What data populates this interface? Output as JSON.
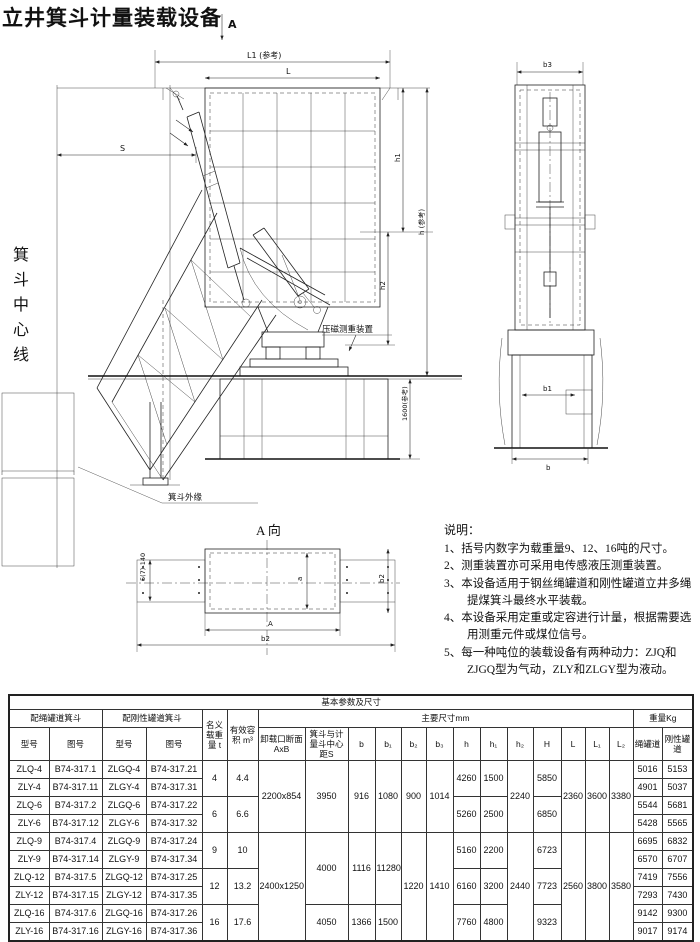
{
  "page": {
    "title": "立井箕斗计量装载设备"
  },
  "drawing": {
    "section_marker": "A",
    "dims": {
      "L1": "L1 (参考)",
      "L": "L",
      "S": "S",
      "h1": "h1",
      "h2": "h2",
      "h_ref": "h (参考)",
      "ref_1600": "1600(参考)",
      "b3": "b3",
      "b1": "b1",
      "b": "b",
      "a_view_left": "5(7)-140",
      "a_view_inner_v": "a",
      "a_view_inner_h": "A",
      "a_view_outer_h": "b2",
      "a_view_right_v": "b2"
    },
    "labels": {
      "skip_centerline": "箕斗中心线",
      "weighing_device": "压磁测重装置",
      "skip_outer_edge": "箕斗外缘",
      "a_view_title": "A 向"
    }
  },
  "notes": {
    "title": "说明：",
    "items": [
      "1、括号内数字为载重量9、12、16吨的尺寸。",
      "2、测重装置亦可采用电传感液压测重装置。",
      "3、本设备适用于钢丝绳罐道和刚性罐道立井多绳提煤箕斗最终水平装载。",
      "4、本设备采用定重或定容进行计量，根据需要选用测重元件或煤位信号。",
      "5、每一种吨位的装载设备有两种动力：ZJQ和ZJGQ型为气动，ZLY和ZLGY型为液动。"
    ]
  },
  "table": {
    "head": [
      [
        {
          "t": "基本参数及尺寸",
          "cs": 21
        }
      ],
      [
        {
          "t": "配绳罐道箕斗",
          "cs": 2
        },
        {
          "t": "配刚性罐道箕斗",
          "cs": 2
        },
        {
          "t": "名义载重量 t",
          "rs": 2
        },
        {
          "t": "有效容积 m³",
          "rs": 2
        },
        {
          "t": "主要尺寸mm",
          "cs": 13
        },
        {
          "t": "重量Kg",
          "cs": 2
        }
      ],
      [
        {
          "t": "型号"
        },
        {
          "t": "图号"
        },
        {
          "t": "型号"
        },
        {
          "t": "图号"
        },
        {
          "t": "卸载口断面AxB"
        },
        {
          "t": "箕斗与计量斗中心距S"
        },
        {
          "t": "b"
        },
        {
          "t": "b₁"
        },
        {
          "t": "b₂"
        },
        {
          "t": "b₃"
        },
        {
          "t": "h"
        },
        {
          "t": "h₁"
        },
        {
          "t": "h₂"
        },
        {
          "t": "H"
        },
        {
          "t": "L"
        },
        {
          "t": "L₁"
        },
        {
          "t": "L₂"
        },
        {
          "t": "绳罐道"
        },
        {
          "t": "刚性罐道"
        }
      ]
    ],
    "body": [
      [
        {
          "t": "ZLQ-4"
        },
        {
          "t": "B74-317.1"
        },
        {
          "t": "ZLGQ-4"
        },
        {
          "t": "B74-317.21"
        },
        {
          "t": "4",
          "rs": 2
        },
        {
          "t": "4.4",
          "rs": 2
        },
        {
          "t": "2200x854",
          "rs": 4
        },
        {
          "t": "3950",
          "rs": 4
        },
        {
          "t": "916",
          "rs": 4
        },
        {
          "t": "1080",
          "rs": 4
        },
        {
          "t": "900",
          "rs": 4
        },
        {
          "t": "1014",
          "rs": 4
        },
        {
          "t": "4260",
          "rs": 2
        },
        {
          "t": "1500",
          "rs": 2
        },
        {
          "t": "2240",
          "rs": 4
        },
        {
          "t": "5850",
          "rs": 2
        },
        {
          "t": "2360",
          "rs": 4
        },
        {
          "t": "3600",
          "rs": 4
        },
        {
          "t": "3380",
          "rs": 4
        },
        {
          "t": "5016"
        },
        {
          "t": "5153"
        }
      ],
      [
        {
          "t": "ZLY-4"
        },
        {
          "t": "B74-317.11"
        },
        {
          "t": "ZLGY-4"
        },
        {
          "t": "B74-317.31"
        },
        {
          "t": "4901"
        },
        {
          "t": "5037"
        }
      ],
      [
        {
          "t": "ZLQ-6"
        },
        {
          "t": "B74-317.2"
        },
        {
          "t": "ZLGQ-6"
        },
        {
          "t": "B74-317.22"
        },
        {
          "t": "6",
          "rs": 2
        },
        {
          "t": "6.6",
          "rs": 2
        },
        {
          "t": "5260",
          "rs": 2
        },
        {
          "t": "2500",
          "rs": 2
        },
        {
          "t": "6850",
          "rs": 2
        },
        {
          "t": "5544"
        },
        {
          "t": "5681"
        }
      ],
      [
        {
          "t": "ZLY-6"
        },
        {
          "t": "B74-317.12"
        },
        {
          "t": "ZLGY-6"
        },
        {
          "t": "B74-317.32"
        },
        {
          "t": "5428"
        },
        {
          "t": "5565"
        }
      ],
      [
        {
          "t": "ZLQ-9"
        },
        {
          "t": "B74-317.4"
        },
        {
          "t": "ZLGQ-9"
        },
        {
          "t": "B74-317.24"
        },
        {
          "t": "9",
          "rs": 2
        },
        {
          "t": "10",
          "rs": 2
        },
        {
          "t": "2400x1250",
          "rs": 6
        },
        {
          "t": "4000",
          "rs": 4
        },
        {
          "t": "1116",
          "rs": 4
        },
        {
          "t": "11280",
          "rs": 4
        },
        {
          "t": "1220",
          "rs": 6
        },
        {
          "t": "1410",
          "rs": 6
        },
        {
          "t": "5160",
          "rs": 2
        },
        {
          "t": "2200",
          "rs": 2
        },
        {
          "t": "2440",
          "rs": 6
        },
        {
          "t": "6723",
          "rs": 2
        },
        {
          "t": "2560",
          "rs": 6
        },
        {
          "t": "3800",
          "rs": 6
        },
        {
          "t": "3580",
          "rs": 6
        },
        {
          "t": "6695"
        },
        {
          "t": "6832"
        }
      ],
      [
        {
          "t": "ZLY-9"
        },
        {
          "t": "B74-317.14"
        },
        {
          "t": "ZLGY-9"
        },
        {
          "t": "B74-317.34"
        },
        {
          "t": "6570"
        },
        {
          "t": "6707"
        }
      ],
      [
        {
          "t": "ZLQ-12"
        },
        {
          "t": "B74-317.5"
        },
        {
          "t": "ZLGQ-12"
        },
        {
          "t": "B74-317.25"
        },
        {
          "t": "12",
          "rs": 2
        },
        {
          "t": "13.2",
          "rs": 2
        },
        {
          "t": "6160",
          "rs": 2
        },
        {
          "t": "3200",
          "rs": 2
        },
        {
          "t": "7723",
          "rs": 2
        },
        {
          "t": "7419"
        },
        {
          "t": "7556"
        }
      ],
      [
        {
          "t": "ZLY-12"
        },
        {
          "t": "B74-317.15"
        },
        {
          "t": "ZLGY-12"
        },
        {
          "t": "B74-317.35"
        },
        {
          "t": "7293"
        },
        {
          "t": "7430"
        }
      ],
      [
        {
          "t": "ZLQ-16"
        },
        {
          "t": "B74-317.6"
        },
        {
          "t": "ZLGQ-16"
        },
        {
          "t": "B74-317.26"
        },
        {
          "t": "16",
          "rs": 2
        },
        {
          "t": "17.6",
          "rs": 2
        },
        {
          "t": "4050",
          "rs": 2
        },
        {
          "t": "1366",
          "rs": 2
        },
        {
          "t": "1500",
          "rs": 2
        },
        {
          "t": "7760",
          "rs": 2
        },
        {
          "t": "4800",
          "rs": 2
        },
        {
          "t": "9323",
          "rs": 2
        },
        {
          "t": "9142"
        },
        {
          "t": "9300"
        }
      ],
      [
        {
          "t": "ZLY-16"
        },
        {
          "t": "B74-317.16"
        },
        {
          "t": "ZLGY-16"
        },
        {
          "t": "B74-317.36"
        },
        {
          "t": "9017"
        },
        {
          "t": "9174"
        }
      ]
    ]
  }
}
